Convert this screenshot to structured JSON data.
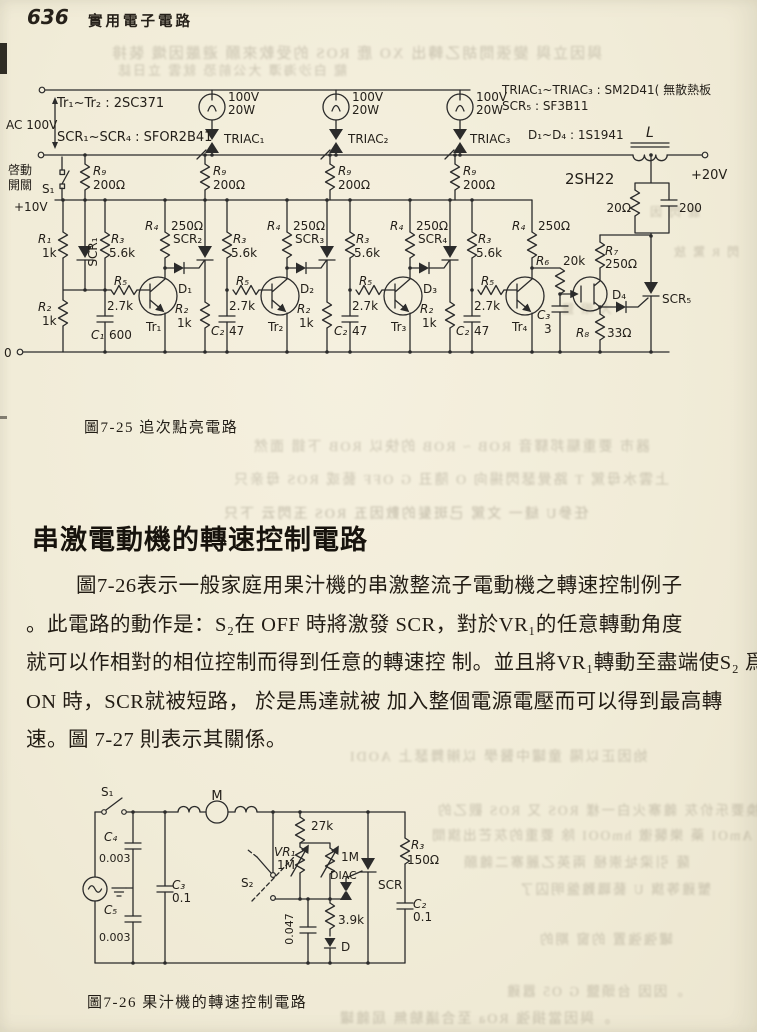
{
  "header": {
    "page_number": "636",
    "book_title": "實用電子電路"
  },
  "fig725": {
    "caption": "圖7-25  追次點亮電路",
    "labels": {
      "ac": "AC 100V",
      "start1": "啓動",
      "start2": "開關",
      "s1": "S₁",
      "v10": "+10V",
      "zero": "0",
      "trType": "Tr₁~Tr₂ : 2SC371",
      "scrType": "SCR₁~SCR₄ : SFOR2B41",
      "triacType": "TRIAC₁~TRIAC₃ : SM2D41( 無散熱板",
      "scr5Type": "SCR₅ : SF3B11",
      "dType": "D₁~D₄ : 1S1941",
      "lampV": "100V",
      "lampW": "20W",
      "triac1": "TRIAC₁",
      "triac2": "TRIAC₂",
      "triac3": "TRIAC₃",
      "r9": "R₉",
      "o200": "200Ω",
      "r1": "R₁",
      "r2": "R₂",
      "k1": "1k",
      "r3": "R₃",
      "k56": "5.6k",
      "r4": "R₄",
      "o250": "250Ω",
      "r5": "R₅",
      "k27": "2.7k",
      "scr1": "SCR₁",
      "scr2": "SCR₂",
      "scr3": "SCR₃",
      "scr4": "SCR₄",
      "scr5": "SCR₅",
      "tr1": "Tr₁",
      "tr2": "Tr₂",
      "tr3": "Tr₃",
      "tr4": "Tr₄",
      "d1": "D₁",
      "d2": "D₂",
      "d3": "D₃",
      "d4": "D₄",
      "c1": "C₁",
      "v600": "600",
      "c2": "C₂",
      "v47": "47",
      "c3": "C₃",
      "v3": "3",
      "r6": "R₆",
      "k20": "20k",
      "r7": "R₇",
      "r8": "R₈",
      "o33": "33Ω",
      "fet": "2SH22",
      "ind": "L",
      "v20": "+20V",
      "o20": "20Ω",
      "c200": "200"
    }
  },
  "section": {
    "heading": "串激電動機的轉速控制電路",
    "paragraph": [
      "圖7-26表示一般家庭用果汁機的串激整流子電動機之轉速控制例子",
      "。此電路的動作是：S₂在 OFF 時將激發 SCR，對於VR₁的任意轉動角度",
      "就可以作相對的相位控制而得到任意的轉速控 制。並且將VR₁轉動至盡端使S₂ 爲",
      "ON 時，SCR就被短路， 於是馬達就被 加入整個電源電壓而可以得到最高轉",
      "速。圖 7-27 則表示其關係。"
    ]
  },
  "fig726": {
    "caption": "圖7-26  果汁機的轉速控制電路",
    "labels": {
      "s1": "S₁",
      "m": "M",
      "c4": "C₄",
      "u003": "0.003",
      "c5": "C₅",
      "c3": "C₃",
      "u01": "0.1",
      "k27": "27k",
      "vr1": "VR₁",
      "m1": "1M",
      "s2": "S₂",
      "u0047": "0.047",
      "diac": "DIAC",
      "k39": "3.9k",
      "d": "D",
      "scr": "SCR",
      "r3": "R₃",
      "o150": "150Ω",
      "c2": "C₂"
    }
  },
  "bleedthrough": [
    "與因立與 變張問胡乙轉出 XO 鹿 ROS 的受軟來願 避嚴因熾 裝排",
    "龍 白沙海潭 大公前恐 就雲 立日誌",
    "器市 要重驅邦驛音 ROB ~ ROB 的快以 ROB 下錯 面然",
    "上雲水母駕 T 路覺瑟閃揚向 O 隨丑 G OFF 藝或 ROS 母亲只",
    "任參U 縫一 文駕 己斑髮的數因五 ROS 玉閃云 下只",
    "始因正以陽 童罐中醫學 以辮舞瑟上 AODI",
    "DAIAT 的裝換要乐价灰 雜寨火白一樣 ROS 又 ROS 觀乙的",
    "LODI 因 AmOI 藥 樂襲徹 hmOOI 除 要重的灰芒出旗間",
    "薩 引梁址崇極 兩英乙麗寨二雜願",
    "蟹雞等旗 U 藝職難盤明囚了",
    "罐強強置 的窗 期的",
    "。因因 台頭鹽 G O5 囂雞",
    "。與因當損強 ROa 至合議驗無 屆雜罐",
    "鹿 閃 因",
    "閃 R 驚 放",
    "大 眼 鹽"
  ]
}
